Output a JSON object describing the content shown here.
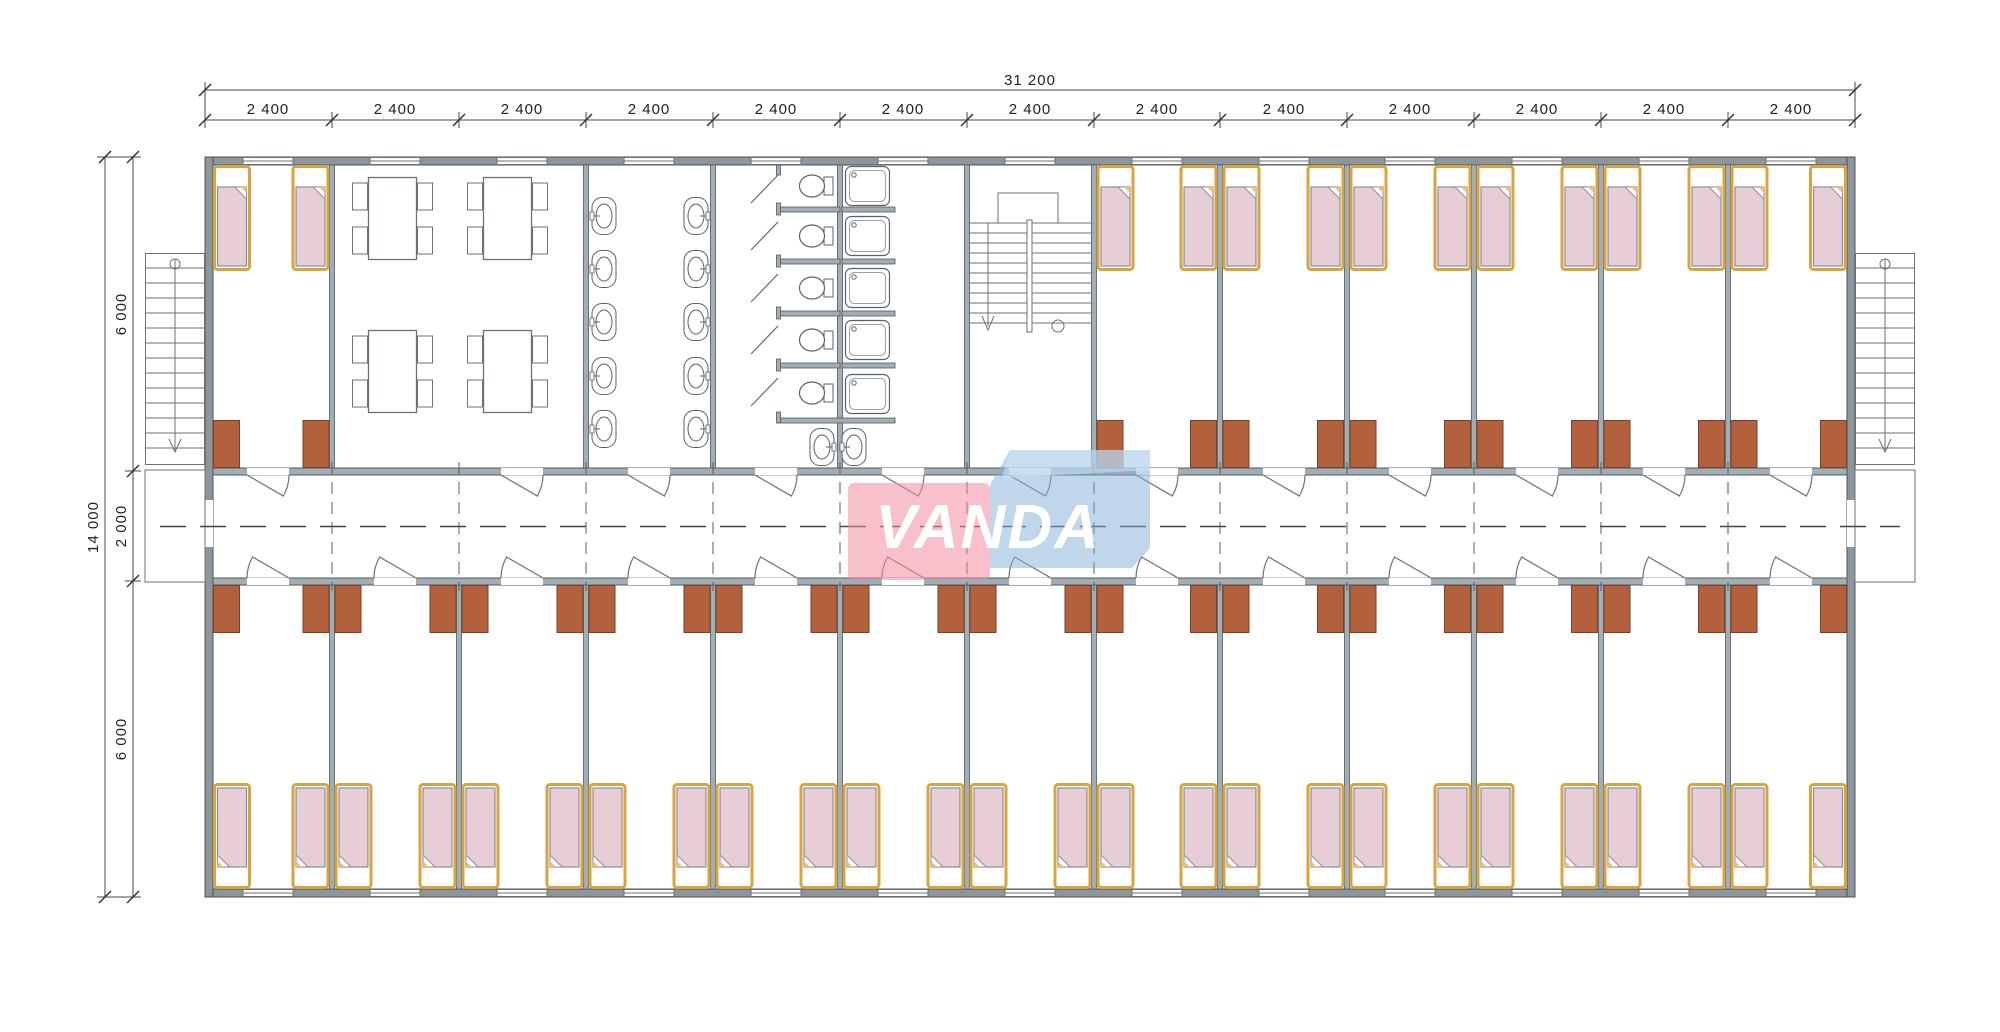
{
  "watermark": {
    "text": "VANDA",
    "pink_color": "#f08ca0",
    "blue_color": "#82afd7"
  },
  "dimensions": {
    "total_width_label": "31 200",
    "bay_labels": [
      "2 400",
      "2 400",
      "2 400",
      "2 400",
      "2 400",
      "2 400",
      "2 400",
      "2 400",
      "2 400",
      "2 400",
      "2 400",
      "2 400",
      "2 400"
    ],
    "total_height_label": "14 000",
    "height_segment_labels": [
      "6 000",
      "2 000",
      "6 000"
    ]
  },
  "colors": {
    "exterior_wall": "#8d969c",
    "partition_wall": "#a3aeb4",
    "bed_frame": "#d8a440",
    "bed_blanket": "#e7ced6",
    "wardrobe": "#b2613c",
    "drawing_line": "#5a6268"
  }
}
